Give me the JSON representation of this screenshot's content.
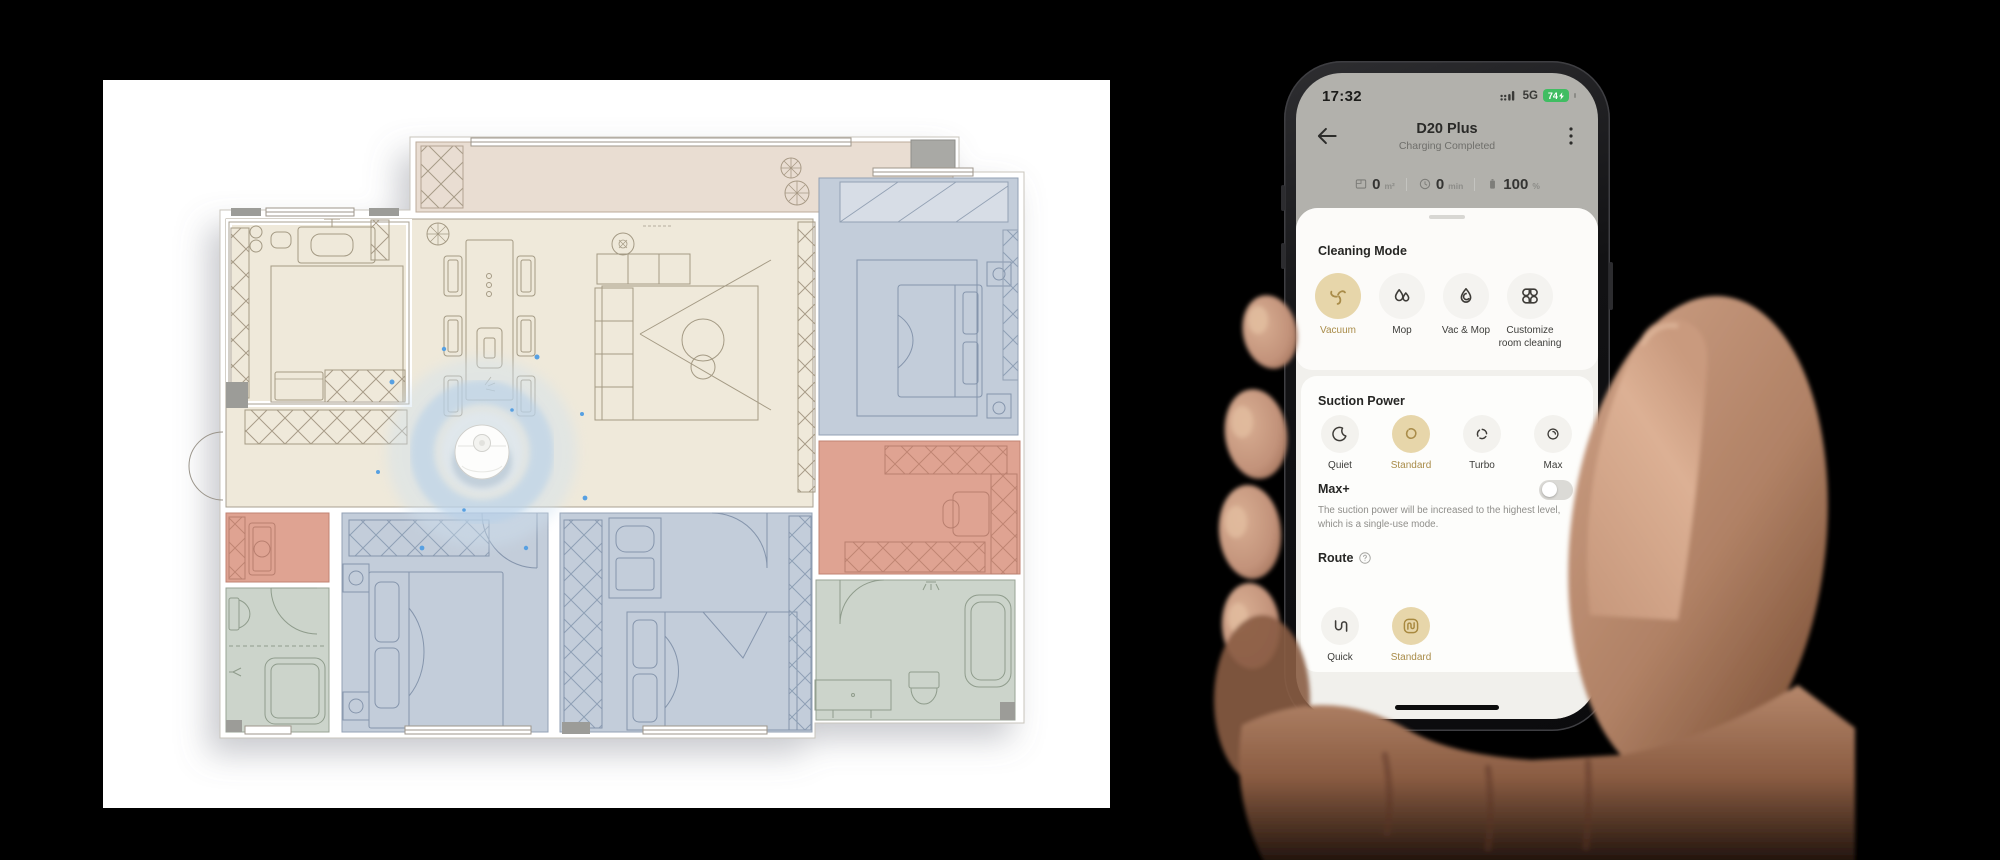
{
  "floor_plan": {
    "palette": {
      "canvas": "#ffffff",
      "living": "#efe9da",
      "balcony": "#e9ddd2",
      "bedroom_blue": "#c3cdda",
      "bathroom_green": "#ccd4cb",
      "dressing_pink": "#dfa392",
      "wall_line": "#a8a091",
      "robot_halo": "#bcd4ea",
      "robot_dot": "#4f9be0"
    }
  },
  "phone": {
    "status_bar": {
      "time": "17:32",
      "network": "5G",
      "battery_percent": "74"
    },
    "header": {
      "title": "D20 Plus",
      "subtitle": "Charging Completed"
    },
    "stats": {
      "area": {
        "value": "0",
        "unit": "m²"
      },
      "minutes": {
        "value": "0",
        "unit": "min"
      },
      "battery": {
        "value": "100",
        "unit": "%"
      }
    },
    "cleaning_mode": {
      "title": "Cleaning Mode",
      "options": [
        {
          "label": "Vacuum",
          "selected": true
        },
        {
          "label": "Mop",
          "selected": false
        },
        {
          "label": "Vac & Mop",
          "selected": false
        },
        {
          "label": "Customize room cleaning",
          "selected": false
        }
      ]
    },
    "suction_power": {
      "title": "Suction Power",
      "options": [
        {
          "label": "Quiet",
          "selected": false
        },
        {
          "label": "Standard",
          "selected": true
        },
        {
          "label": "Turbo",
          "selected": false
        },
        {
          "label": "Max",
          "selected": false
        }
      ]
    },
    "max_plus": {
      "title": "Max+",
      "description": "The suction power will be increased to the highest level, which is a single-use mode.",
      "enabled": false
    },
    "route": {
      "title": "Route",
      "options": [
        {
          "label": "Quick",
          "selected": false
        },
        {
          "label": "Standard",
          "selected": true
        }
      ]
    },
    "accent": {
      "selected_bg": "#e7d6aa",
      "selected_text": "#a98c49"
    }
  }
}
